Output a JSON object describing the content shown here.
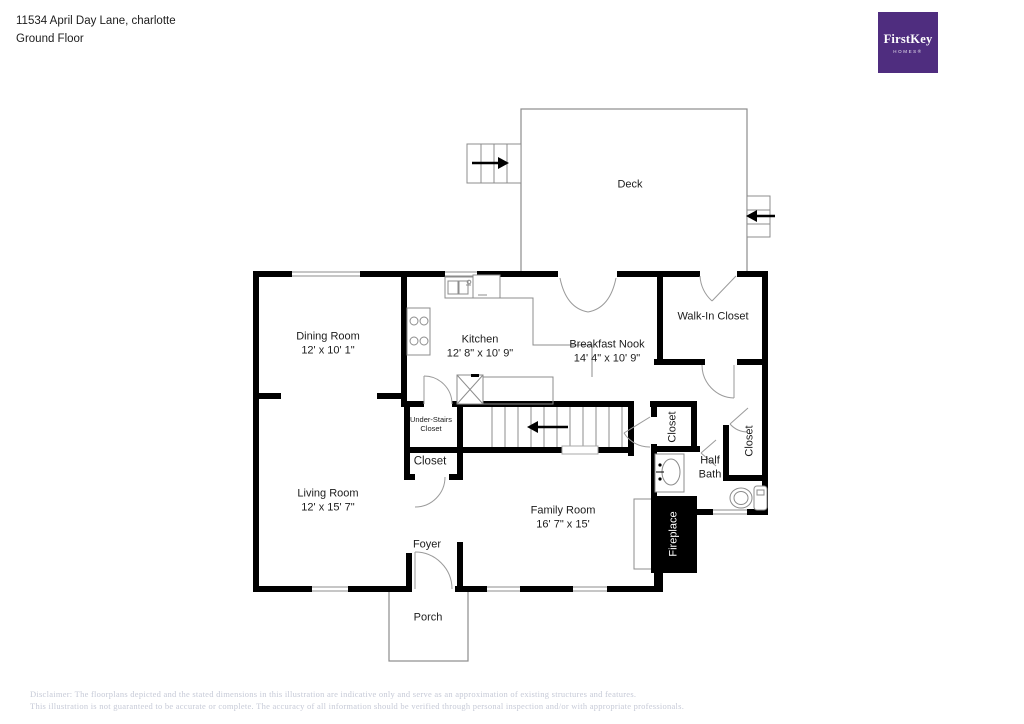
{
  "header": {
    "address": "11534 April Day Lane, charlotte",
    "floor": "Ground Floor"
  },
  "logo": {
    "brand": "FirstKey",
    "sub": "HOMES®"
  },
  "rooms": {
    "deck": {
      "name": "Deck"
    },
    "dining": {
      "name": "Dining Room",
      "dims": "12' x 10' 1\""
    },
    "kitchen": {
      "name": "Kitchen",
      "dims": "12' 8\" x 10' 9\""
    },
    "breakfast": {
      "name": "Breakfast Nook",
      "dims": "14' 4\" x 10' 9\""
    },
    "walkin": {
      "name": "Walk-In Closet"
    },
    "understairs": {
      "line1": "Under-Stairs",
      "line2": "Closet"
    },
    "closet_hall": {
      "name": "Closet"
    },
    "closet_left": {
      "name": "Closet"
    },
    "closet_right": {
      "name": "Closet"
    },
    "halfbath": {
      "line1": "Half",
      "line2": "Bath"
    },
    "living": {
      "name": "Living Room",
      "dims": "12' x 15' 7\""
    },
    "family": {
      "name": "Family Room",
      "dims": "16' 7\" x 15'"
    },
    "fireplace": {
      "name": "Fireplace"
    },
    "foyer": {
      "name": "Foyer"
    },
    "porch": {
      "name": "Porch"
    }
  },
  "disclaimer": {
    "line1": "Disclaimer: The floorplans depicted and the stated dimensions in this illustration are indicative only and serve as an approximation of existing structures and features.",
    "line2": "This illustration is not guaranteed to be accurate or complete. The accuracy of all information should be verified through personal inspection and/or with appropriate professionals."
  },
  "colors": {
    "wall": "#000000",
    "thin_line": "#8c8c8c",
    "logo_purple": "#4F2D7F",
    "disclaimer_text": "#c6cad7"
  }
}
